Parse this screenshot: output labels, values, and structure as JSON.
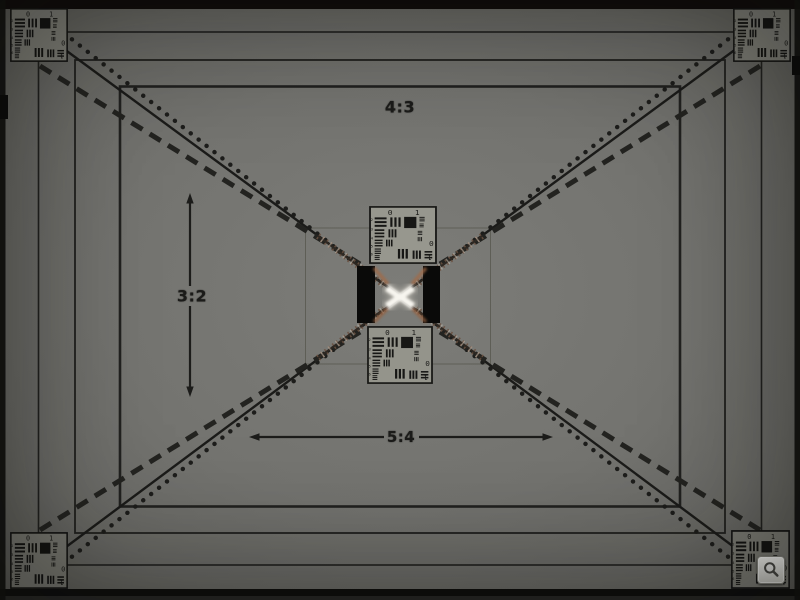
{
  "photo": {
    "description_labels": {
      "aspect_ratio_top": "4:3",
      "aspect_ratio_left": "3:2",
      "aspect_ratio_bottom": "5:4"
    },
    "usaf_chart": {
      "top_left_digit": "0",
      "top_right_digit": "1",
      "side_digits": [
        "2",
        "3",
        "4",
        "5",
        "6"
      ],
      "rotated_right_digit": "0",
      "rotated_bottom_digit": "1"
    },
    "colors": {
      "background_gray": "#73736f",
      "line_black": "#1c1c1a",
      "target_background": "#8e8e86",
      "center_highlight": "#f7f5ef",
      "chromatic_artifact": "#8a5f44",
      "black_bar": "#0a0a09",
      "button_face": "#e9e9e4"
    }
  },
  "viewer": {
    "zoom_button_icon": "magnifier-icon"
  }
}
